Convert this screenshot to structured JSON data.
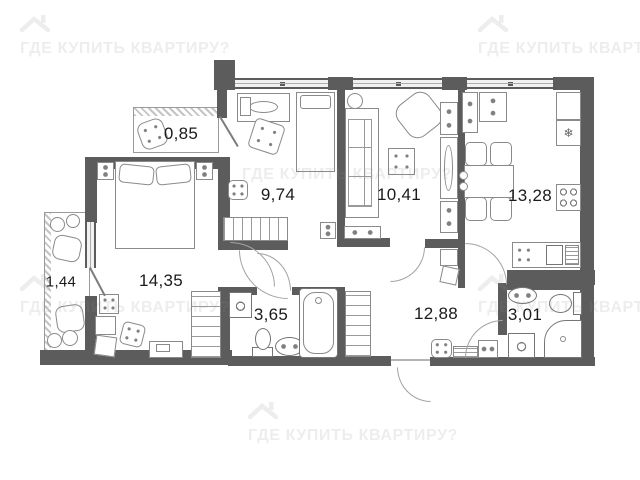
{
  "watermark": {
    "text": "ГДЕ КУПИТЬ КВАРТИРУ?",
    "icon": "house-roof-icon",
    "color": "#8f8f8f"
  },
  "plan": {
    "rooms": [
      {
        "name": "loggia-small",
        "area": "0,85"
      },
      {
        "name": "bedroom-1",
        "area": "9,74"
      },
      {
        "name": "living-room",
        "area": "10,41"
      },
      {
        "name": "kitchen",
        "area": "13,28"
      },
      {
        "name": "bedroom-2",
        "area": "14,35"
      },
      {
        "name": "balcony",
        "area": "1,44"
      },
      {
        "name": "bathroom",
        "area": "3,65"
      },
      {
        "name": "hallway",
        "area": "12,88"
      },
      {
        "name": "wc",
        "area": "3,01"
      }
    ],
    "glyphs": {
      "snowflake": "❄"
    }
  }
}
